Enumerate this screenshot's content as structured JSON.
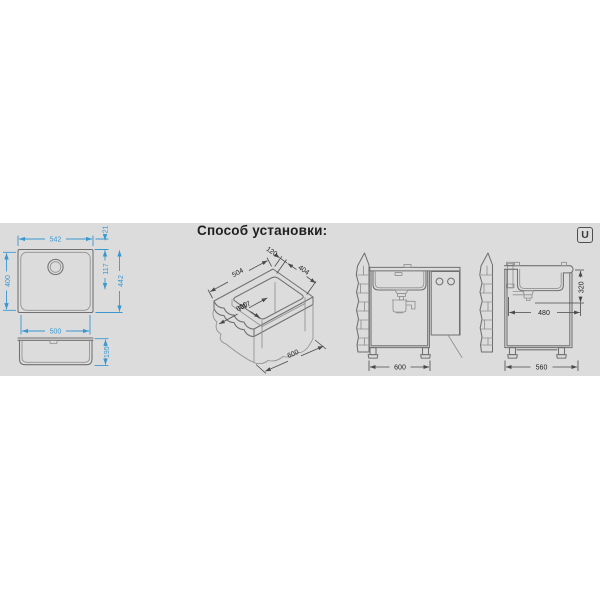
{
  "title": "Способ установки:",
  "corner_badge": "U",
  "colors": {
    "band_bg": "#dcdcdc",
    "line_gray": "#707070",
    "line_gray2": "#909090",
    "dim_blue": "#3a97d0",
    "dim_dark": "#4a4a4a",
    "text_black": "#1f1f1f"
  },
  "top_view": {
    "overall_width": "542",
    "rim_width": "21",
    "overall_depth": "400",
    "drain_offset": "117",
    "depth_with_rim": "442",
    "bowl_width": "500",
    "bowl_depth": "195"
  },
  "cutout_view": {
    "back_offset": "120",
    "cutout_width": "404",
    "cutout_length": "504",
    "corner_radius": "R17",
    "counter_depth": "600",
    "counter_width": "600"
  },
  "front_view": {
    "cabinet_width": "600"
  },
  "side_view": {
    "mount_depth": "320",
    "clearance": "480",
    "cabinet_depth": "560"
  }
}
